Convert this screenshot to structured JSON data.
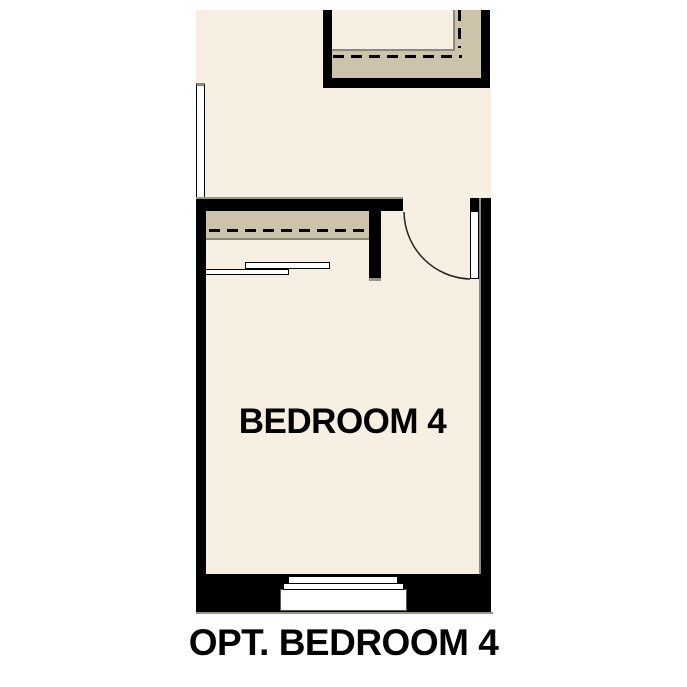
{
  "figure": {
    "room_label": "BEDROOM 4",
    "caption": "OPT. BEDROOM 4"
  },
  "colors": {
    "background": "#ffffff",
    "floor": "#f7efe2",
    "closet_fill": "#cdc3ab",
    "wall": "#000000",
    "outline_gray": "#8d887c",
    "line_gray": "#9a9489"
  }
}
